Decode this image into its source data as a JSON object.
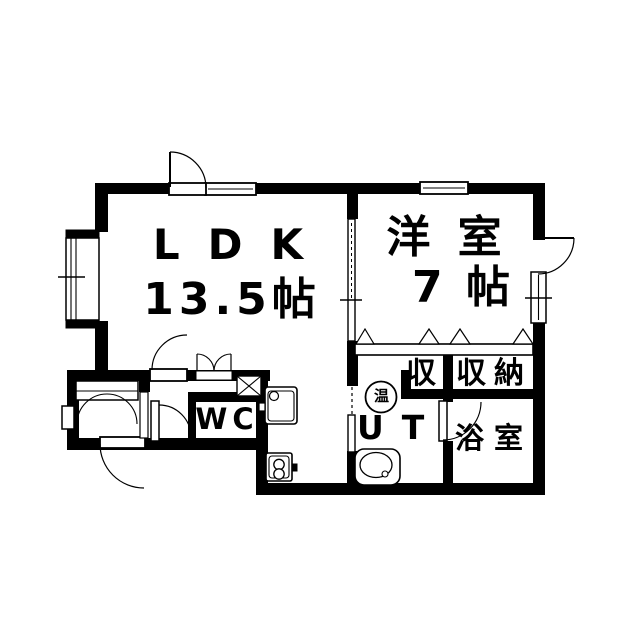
{
  "plan": {
    "background": "#ffffff",
    "ink": "#000000",
    "rooms": {
      "ldk": {
        "name": "LDK",
        "size": "13.5帖"
      },
      "western": {
        "name": "洋 室",
        "size": "7 帖"
      },
      "wc": {
        "label": "WC"
      },
      "utility": {
        "label": "UT"
      },
      "bathroom": {
        "label": "浴室"
      },
      "closet": {
        "label": "収"
      },
      "storage": {
        "label": "収納"
      },
      "water_heater": {
        "label": "温"
      }
    }
  }
}
